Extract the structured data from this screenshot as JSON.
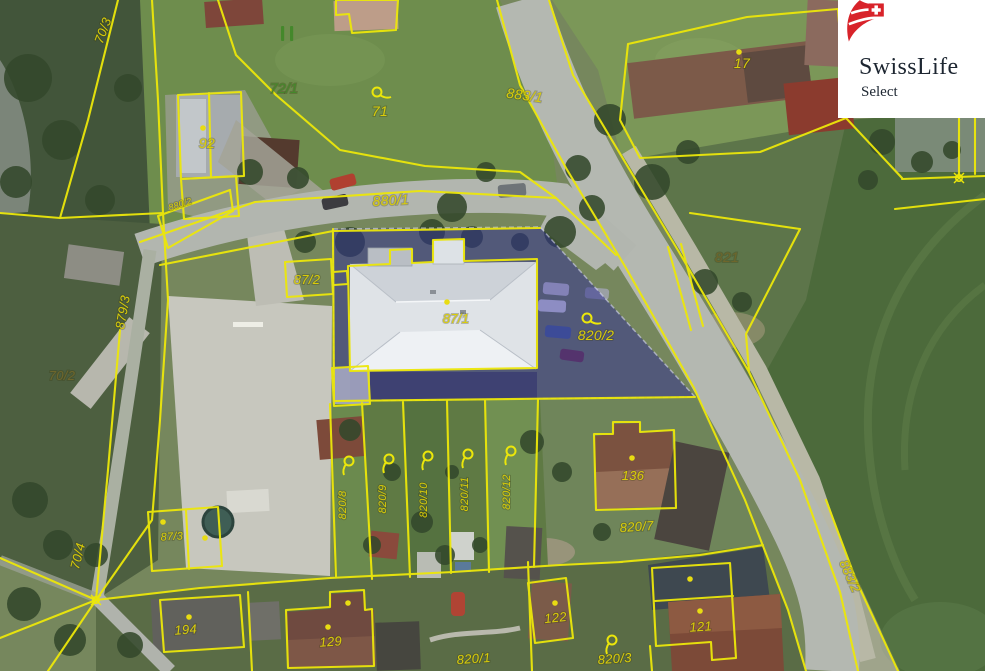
{
  "logo": {
    "brand": "SwissLife",
    "sub": "Select",
    "brand_color": "#d8232a"
  },
  "map": {
    "highlight": {
      "parcel": "820/2",
      "fill": "#2d2b96",
      "opacity": 0.5
    },
    "line_color": "#ece70a",
    "label_colors": {
      "yellow": "#d9cc09",
      "green": "#44882b",
      "olive": "#6e662c"
    },
    "labels": [
      {
        "t": "70/3",
        "x": 107,
        "y": 32,
        "r": -70,
        "s": 13,
        "c": "yellow"
      },
      {
        "t": "879/3",
        "x": 127,
        "y": 313,
        "r": -80,
        "s": 13,
        "c": "yellow"
      },
      {
        "t": "92",
        "x": 207,
        "y": 148,
        "r": 0,
        "s": 14,
        "c": "yellow"
      },
      {
        "t": "72/1",
        "x": 284,
        "y": 93,
        "r": 0,
        "s": 14,
        "c": "green"
      },
      {
        "t": "71",
        "x": 380,
        "y": 116,
        "r": 0,
        "s": 14,
        "c": "yellow"
      },
      {
        "t": "883/1",
        "x": 524,
        "y": 100,
        "r": 8,
        "s": 14,
        "c": "yellow"
      },
      {
        "t": "880/1",
        "x": 391,
        "y": 205,
        "r": -3,
        "s": 14,
        "c": "yellow"
      },
      {
        "t": "880/2",
        "x": 181,
        "y": 207,
        "r": -18,
        "s": 9,
        "c": "yellow"
      },
      {
        "t": "87/2",
        "x": 307,
        "y": 284,
        "r": 0,
        "s": 13,
        "c": "yellow"
      },
      {
        "t": "87/1",
        "x": 456,
        "y": 323,
        "r": 0,
        "s": 13,
        "c": "yellow"
      },
      {
        "t": "820/2",
        "x": 596,
        "y": 340,
        "r": 0,
        "s": 14,
        "c": "yellow"
      },
      {
        "t": "821",
        "x": 727,
        "y": 262,
        "r": 0,
        "s": 14,
        "c": "olive"
      },
      {
        "t": "17",
        "x": 742,
        "y": 68,
        "r": 0,
        "s": 14,
        "c": "yellow"
      },
      {
        "t": "70/2",
        "x": 62,
        "y": 380,
        "r": 0,
        "s": 13,
        "c": "olive"
      },
      {
        "t": "70/4",
        "x": 82,
        "y": 557,
        "r": -76,
        "s": 13,
        "c": "yellow"
      },
      {
        "t": "87/3",
        "x": 172,
        "y": 540,
        "r": -3,
        "s": 11,
        "c": "yellow"
      },
      {
        "t": "194",
        "x": 186,
        "y": 634,
        "r": -4,
        "s": 13,
        "c": "yellow"
      },
      {
        "t": "129",
        "x": 331,
        "y": 646,
        "r": -4,
        "s": 13,
        "c": "yellow"
      },
      {
        "t": "820/8",
        "x": 346,
        "y": 505,
        "r": -90,
        "s": 11,
        "c": "yellow"
      },
      {
        "t": "820/9",
        "x": 386,
        "y": 499,
        "r": -90,
        "s": 11,
        "c": "yellow"
      },
      {
        "t": "820/10",
        "x": 427,
        "y": 500,
        "r": -90,
        "s": 11,
        "c": "yellow"
      },
      {
        "t": "820/11",
        "x": 468,
        "y": 494,
        "r": -90,
        "s": 11,
        "c": "yellow"
      },
      {
        "t": "820/12",
        "x": 510,
        "y": 492,
        "r": -90,
        "s": 11,
        "c": "yellow"
      },
      {
        "t": "136",
        "x": 633,
        "y": 480,
        "r": 0,
        "s": 13,
        "c": "yellow"
      },
      {
        "t": "820/7",
        "x": 637,
        "y": 531,
        "r": -4,
        "s": 13,
        "c": "yellow"
      },
      {
        "t": "122",
        "x": 556,
        "y": 622,
        "r": -6,
        "s": 13,
        "c": "yellow"
      },
      {
        "t": "820/1",
        "x": 474,
        "y": 663,
        "r": -4,
        "s": 13,
        "c": "yellow"
      },
      {
        "t": "820/3",
        "x": 615,
        "y": 663,
        "r": -4,
        "s": 13,
        "c": "yellow"
      },
      {
        "t": "121",
        "x": 701,
        "y": 631,
        "r": -4,
        "s": 13,
        "c": "yellow"
      },
      {
        "t": "883/2",
        "x": 846,
        "y": 578,
        "r": 66,
        "s": 13,
        "c": "yellow"
      }
    ],
    "dots": [
      {
        "x": 739,
        "y": 52
      },
      {
        "x": 632,
        "y": 458
      },
      {
        "x": 189,
        "y": 617
      },
      {
        "x": 328,
        "y": 627
      },
      {
        "x": 555,
        "y": 603
      },
      {
        "x": 690,
        "y": 579
      },
      {
        "x": 700,
        "y": 611
      },
      {
        "x": 163,
        "y": 522
      },
      {
        "x": 205,
        "y": 538
      },
      {
        "x": 447,
        "y": 302
      },
      {
        "x": 203,
        "y": 128
      },
      {
        "x": 348,
        "y": 603
      }
    ],
    "loops": [
      {
        "x": 377,
        "y": 92,
        "r": 0
      },
      {
        "x": 587,
        "y": 318,
        "r": 0
      },
      {
        "x": 612,
        "y": 640,
        "r": 90
      },
      {
        "x": 349,
        "y": 461,
        "r": 90
      },
      {
        "x": 389,
        "y": 459,
        "r": 90
      },
      {
        "x": 428,
        "y": 456,
        "r": 90
      },
      {
        "x": 468,
        "y": 454,
        "r": 90
      },
      {
        "x": 511,
        "y": 451,
        "r": 90
      }
    ],
    "junctions": [
      {
        "x": 959,
        "y": 178
      },
      {
        "x": 96,
        "y": 600
      }
    ],
    "meadow_mark": {
      "x": 281,
      "y": 26
    }
  }
}
